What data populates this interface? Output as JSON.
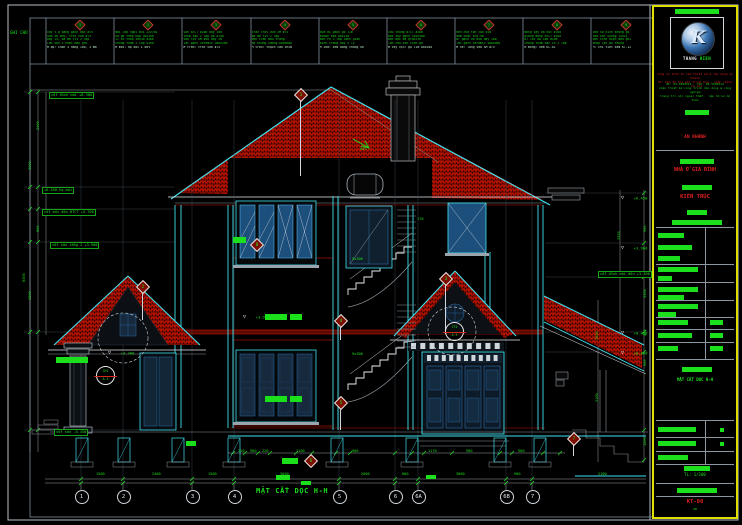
{
  "colors": {
    "background": "#000000",
    "line_cyan": "#3fe3ef",
    "dim_green": "#1be01b",
    "roof_red": "#c01000",
    "titleblock_yellow": "#dede00",
    "steel_blue": "#2b6da8",
    "callout_red": "#d22820"
  },
  "sheet": {
    "notes_header": "GHI CHÚ",
    "section_title": "MẶT CẮT DỌC H-H",
    "notes": [
      {
        "id": "1",
        "lines": [
          "xây t.g bằng gạch đặc #75",
          "vữa XM #50, trát vữa #75",
          "dày 15, bả ma tít 2 lớp",
          "lăn sơn 3 nước màu ghi",
          "M ốp: chân 3 hàng 100, 3 mm"
        ]
      },
      {
        "id": "2",
        "lines": [
          "mái lợp ngói mũi 22v/m2",
          "xà gồ thép hộp 50x100",
          "li tô thép 30x30 a300",
          "chống thấm 2 lớp sika",
          "M mái: độ dốc i 60%"
        ]
      },
      {
        "id": "3",
        "lines": [
          "sàn BTCT #200 dày 100",
          "thép sàn 2 lớp d8 a150",
          "vữa lót XM #50 dày 20",
          "lát gạch ceramic 300x300",
          "M trần: trát vữa #75"
        ]
      },
      {
        "id": "4",
        "lines": [
          "trần trát vữa XM #75",
          "bả ma tít 2 lớp",
          "sơn trần màu trắng",
          "hệ khung xương 600x600",
          "M trần: thạch cao chìm"
        ]
      },
      {
        "id": "5",
        "lines": [
          "cửa đi pano gỗ lim",
          "khuôn kép 60x130",
          "sơn PU 3 lớp cánh gián",
          "kính trắng dày 5 ly",
          "M cửa: xem bảng thống kê"
        ]
      },
      {
        "id": "6",
        "lines": [
          "cầu thang BTCT #200",
          "bậc xây gạch 105x300",
          "mặt bậc đá granite",
          "lan can con tiện gỗ",
          "M tay vịn: gỗ lim 80x100"
        ]
      },
      {
        "id": "7",
        "lines": [
          "nền nhà tôn cao 450",
          "đầm chặt k=0.90",
          "BT gạch vỡ #50 dày 100",
          "lát gạch ceramic 400x400",
          "M hè: láng vữa XM #75"
        ]
      },
      {
        "id": "8",
        "lines": [
          "móng xây đá hộc #100",
          "giằng móng BTCT #200",
          "BT lót đá 4x6 #100",
          "chống thấm hắc ín 2 lớp",
          "M móng: xem KC-01"
        ]
      },
      {
        "id": "9",
        "lines": [
          "cửa sổ kính khung gỗ",
          "hoa sắt vuông 14x14",
          "sơn tĩnh điện màu ghi",
          "chớp lật gỗ thông",
          "M: chi tiết xem KT-12"
        ]
      }
    ],
    "grid_bubbles": [
      {
        "label": "1",
        "x": 81
      },
      {
        "label": "2",
        "x": 123
      },
      {
        "label": "3",
        "x": 192
      },
      {
        "label": "4",
        "x": 234
      },
      {
        "label": "5",
        "x": 339
      },
      {
        "label": "6",
        "x": 395
      },
      {
        "label": "6A",
        "x": 418
      },
      {
        "label": "6B",
        "x": 506
      },
      {
        "label": "7",
        "x": 532
      }
    ],
    "dim_texts": [
      {
        "x": 238,
        "y": 450,
        "v": "220"
      },
      {
        "x": 250,
        "y": 450,
        "v": "900"
      },
      {
        "x": 262,
        "y": 450,
        "v": "220"
      },
      {
        "x": 296,
        "y": 450,
        "v": "1100"
      },
      {
        "x": 352,
        "y": 450,
        "v": "900"
      },
      {
        "x": 428,
        "y": 450,
        "v": "1170"
      },
      {
        "x": 466,
        "y": 450,
        "v": "900"
      },
      {
        "x": 518,
        "y": 450,
        "v": "560"
      },
      {
        "x": 96,
        "y": 473,
        "v": "1500"
      },
      {
        "x": 152,
        "y": 473,
        "v": "2400"
      },
      {
        "x": 208,
        "y": 473,
        "v": "1500"
      },
      {
        "x": 280,
        "y": 473,
        "v": "3600"
      },
      {
        "x": 361,
        "y": 473,
        "v": "2000"
      },
      {
        "x": 402,
        "y": 473,
        "v": "800"
      },
      {
        "x": 456,
        "y": 473,
        "v": "3000"
      },
      {
        "x": 514,
        "y": 473,
        "v": "900"
      },
      {
        "x": 598,
        "y": 473,
        "v": "2100"
      },
      {
        "x": 29,
        "y": 170,
        "v": "3300",
        "r": 1
      },
      {
        "x": 29,
        "y": 300,
        "v": "3300",
        "r": 1
      },
      {
        "x": 37,
        "y": 130,
        "v": "2400",
        "r": 1
      },
      {
        "x": 37,
        "y": 232,
        "v": "900",
        "r": 1
      },
      {
        "x": 23,
        "y": 282,
        "v": "8300",
        "r": 1
      },
      {
        "x": 644,
        "y": 232,
        "v": "900",
        "r": 1
      },
      {
        "x": 644,
        "y": 298,
        "v": "3300",
        "r": 1
      },
      {
        "x": 644,
        "y": 336,
        "v": "450",
        "r": 1
      },
      {
        "x": 644,
        "y": 366,
        "v": "600",
        "r": 1
      },
      {
        "x": 644,
        "y": 446,
        "v": "1200",
        "r": 1
      },
      {
        "x": 618,
        "y": 240,
        "v": "2550",
        "r": 1
      },
      {
        "x": 596,
        "y": 340,
        "v": "1500",
        "r": 1
      },
      {
        "x": 596,
        "y": 402,
        "v": "2100",
        "r": 1
      },
      {
        "x": 352,
        "y": 258,
        "v": "9x300"
      },
      {
        "x": 352,
        "y": 353,
        "v": "9x300"
      },
      {
        "x": 360,
        "y": 148,
        "v": "60%"
      },
      {
        "x": 417,
        "y": 218,
        "v": "170"
      }
    ],
    "levels": [
      {
        "x": 621,
        "y": 193,
        "v": "+6.450"
      },
      {
        "x": 621,
        "y": 243,
        "v": "+3.900"
      },
      {
        "x": 621,
        "y": 328,
        "v": "+0.450"
      },
      {
        "x": 621,
        "y": 348,
        "v": "±0.000"
      },
      {
        "x": 243,
        "y": 312,
        "v": "+3.900"
      },
      {
        "x": 108,
        "y": 348,
        "v": "+3.300"
      }
    ],
    "boxed_labels": [
      {
        "x": 49,
        "y": 92,
        "v": "cốt đỉnh mái +8.300"
      },
      {
        "x": 42,
        "y": 187,
        "v": "+6.450 hạ mái"
      },
      {
        "x": 42,
        "y": 209,
        "v": "cốt mái đón BTCT +5.700"
      },
      {
        "x": 50,
        "y": 242,
        "v": "cốt sàn tầng 2 +3.900"
      },
      {
        "x": 598,
        "y": 271,
        "v": "cốt đỉnh mái đón +3.300"
      },
      {
        "x": 54,
        "y": 429,
        "v": "cốt sân -0.450"
      }
    ],
    "diamonds": [
      {
        "x": 296,
        "y": 90,
        "n": "1",
        "l": 78
      },
      {
        "x": 138,
        "y": 282,
        "n": "2",
        "l": 30
      },
      {
        "x": 441,
        "y": 274,
        "n": "3",
        "l": 52
      },
      {
        "x": 336,
        "y": 316,
        "n": "4",
        "l": 16
      },
      {
        "x": 336,
        "y": 398,
        "n": "5",
        "l": 24
      },
      {
        "x": 306,
        "y": 456,
        "n": "6",
        "l": 0
      },
      {
        "x": 569,
        "y": 434,
        "n": "7",
        "l": 14
      },
      {
        "x": 252,
        "y": 240,
        "n": "8",
        "l": 0
      }
    ],
    "callout_circles": [
      {
        "x": 96,
        "y": 366,
        "t": "CH1",
        "b": "A-3"
      },
      {
        "x": 445,
        "y": 322,
        "t": "CT5",
        "b": "A-3"
      }
    ]
  },
  "titleblock": {
    "logo_glyph": "K",
    "logo_text_1": "THANG",
    "logo_text_2": "HIEN",
    "company_red_lines": [
      "công ty tnhh tư vấn thiết kế & xây dựng an khánh",
      "đc: khu đô thị mới trung hoà - nhân chính - hà nội"
    ],
    "company_green_lines": [
      "đt: 04.5584512 - fax: 04.5584512",
      "nhận thiết kế công trình dân dụng & công nghiệp",
      "trang trí nội ngoại thất - lập hồ sơ dự toán"
    ],
    "project_owner": "AN KHÁNH",
    "project_name": "NHÀ Ở GIA ĐÌNH",
    "category": "KIẾN TRÚC",
    "drawing_title": "MẶT CẮT DỌC H-H",
    "scale_value": "TL: 1/100",
    "sheet_no": "KT-08",
    "sheet_sub": "08"
  }
}
